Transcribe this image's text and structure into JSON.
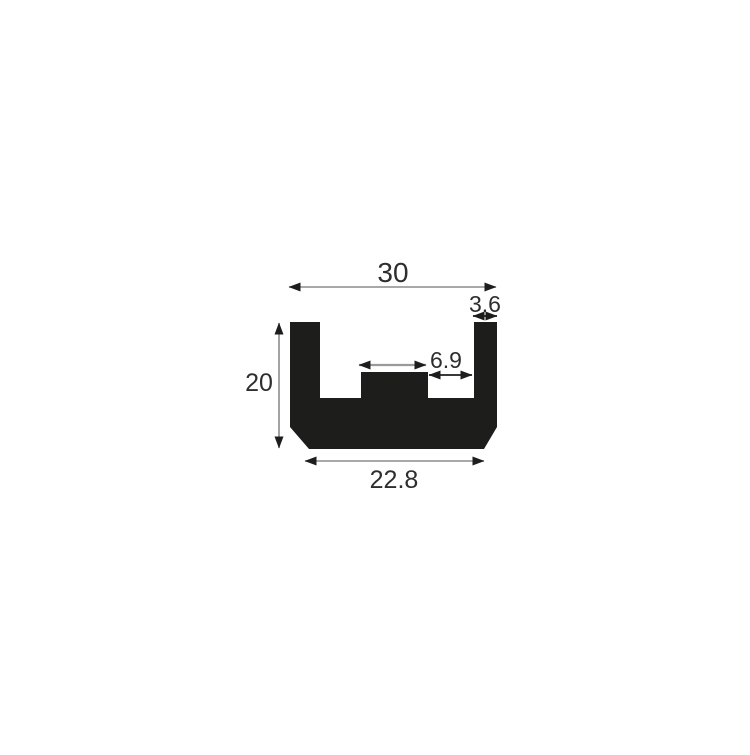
{
  "diagram": {
    "description": "Cross-section profile drawing of a black U-channel extrusion with a raised center rib and chamfered bottom corners, annotated with dimension arrows",
    "background_color": "#ffffff",
    "shape_color": "#1d1d1b",
    "text_color": "#2e2e2e",
    "dimension_line_color": "#8c8c8c",
    "arrowhead_color": "#1d1d1b",
    "dimensions": {
      "overall_width": "30",
      "right_wall_thickness": "3.6",
      "gap_width": "6.9",
      "overall_height": "20",
      "base_width": "22.8"
    }
  }
}
